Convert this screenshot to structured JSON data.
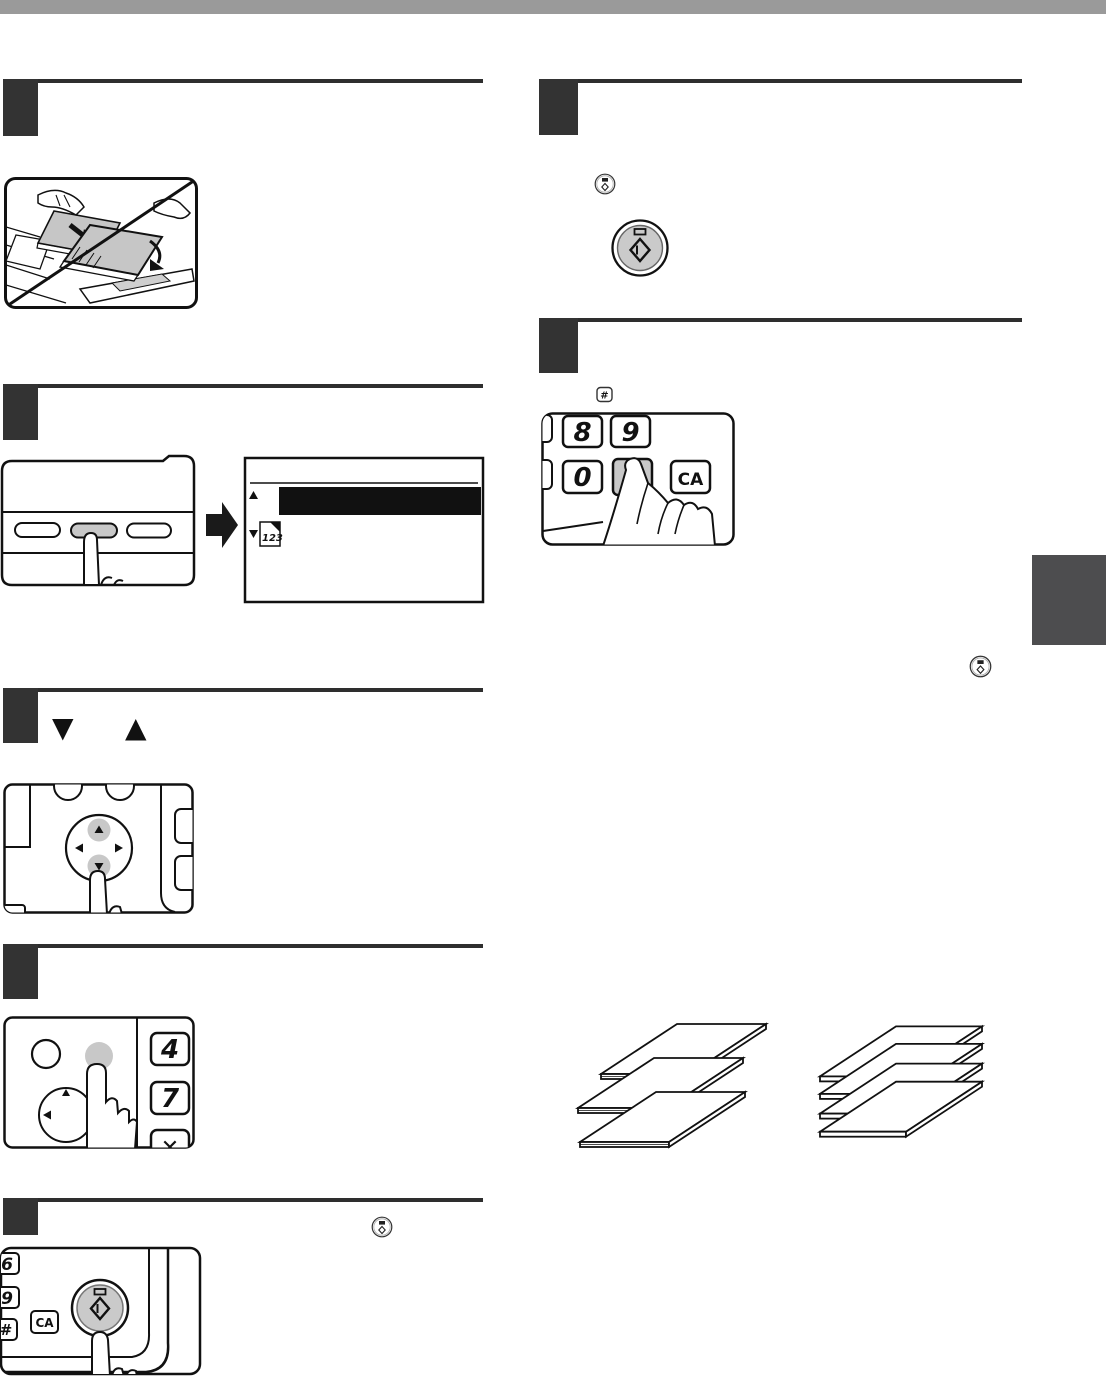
{
  "page": {
    "top_bar_color": "#9a9a9a",
    "chapter_tab_color": "#4d4d4f",
    "step_box_color": "#333333",
    "rule_color": "#2e2e2e",
    "pressed_key_gray": "#c8c8c8"
  },
  "left": {
    "step3_heading": {
      "down_glyph": "▼",
      "up_glyph": "▲"
    },
    "step2_display": {
      "sort_badge": "123"
    },
    "step4_keys": {
      "four": "4",
      "seven": "7",
      "times": "✕"
    },
    "step5_keys": {
      "six": "6",
      "nine": "9",
      "hash": "#",
      "clear": "CA"
    }
  },
  "right": {
    "hash_icon_label": "#",
    "step2_keys": {
      "eight": "8",
      "nine": "9",
      "zero": "0",
      "hash": "#",
      "clear": "CA"
    }
  }
}
